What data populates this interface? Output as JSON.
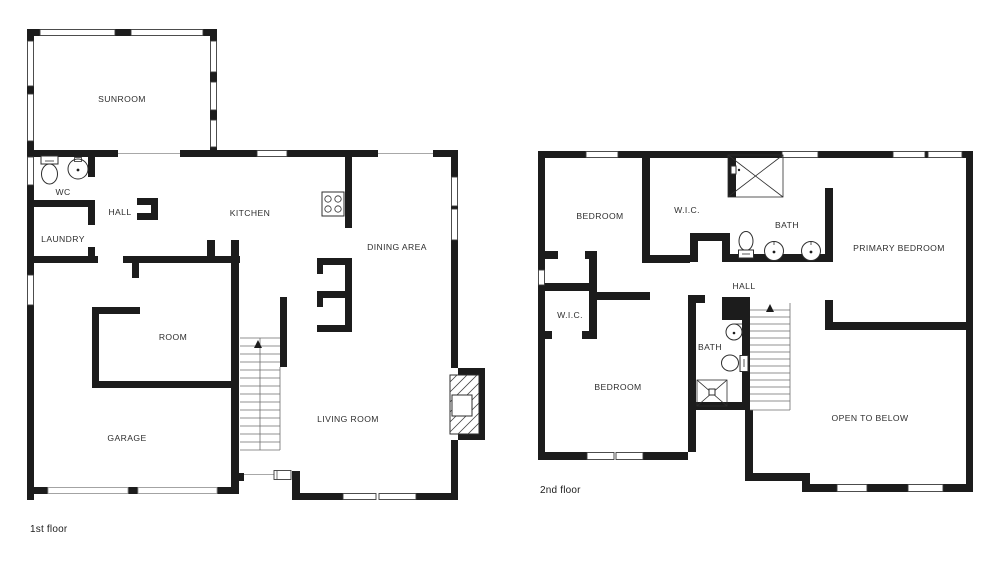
{
  "colors": {
    "wall": "#1c1c1c",
    "background": "#ffffff",
    "label": "#2e2e2e"
  },
  "floor1": {
    "caption": "1st floor",
    "rooms": {
      "sunroom": "SUNROOM",
      "wc": "WC",
      "hall": "HALL",
      "laundry": "LAUNDRY",
      "kitchen": "KITCHEN",
      "dining_area": "DINING AREA",
      "room": "ROOM",
      "garage": "GARAGE",
      "living_room": "LIVING ROOM"
    }
  },
  "floor2": {
    "caption": "2nd floor",
    "rooms": {
      "bedroom_top_left": "BEDROOM",
      "wic_top": "W.I.C.",
      "bath_top": "BATH",
      "primary_bedroom": "PRIMARY BEDROOM",
      "hall": "HALL",
      "wic_left": "W.I.C.",
      "bedroom_bottom": "BEDROOM",
      "bath_lower": "BATH",
      "open_to_below": "OPEN TO BELOW"
    }
  },
  "icons": {
    "toilet": "toilet",
    "sink": "round sink",
    "stove": "4-burner stove",
    "shower": "shower with X",
    "fireplace": "hatched fireplace",
    "stairs_arrow": "up arrow",
    "window": "double-line window",
    "garage_door": "garage door opening",
    "entry_door": "front door"
  }
}
